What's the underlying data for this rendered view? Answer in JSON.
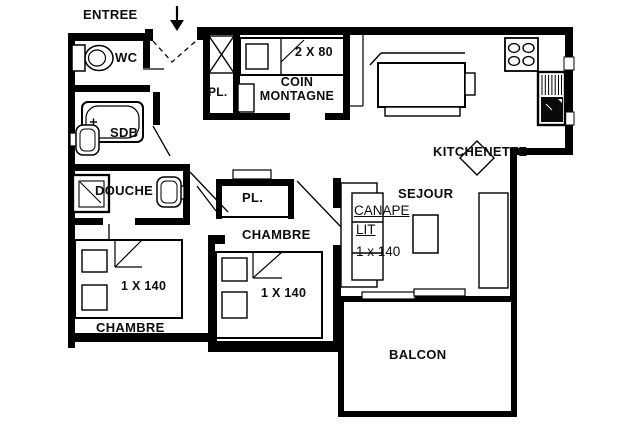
{
  "title": "Apartment floor plan",
  "colors": {
    "wall": "#000000",
    "background": "#ffffff",
    "ink": "#0d0d0d"
  },
  "rooms": {
    "entree": {
      "label": "ENTREE"
    },
    "wc": {
      "label": "WC"
    },
    "sdb": {
      "label": "SDB"
    },
    "douche": {
      "label": "DOUCHE"
    },
    "closet_entree": {
      "label": "PL."
    },
    "coin_montagne": {
      "label_line1": "COIN",
      "label_line2": "MONTAGNE",
      "bed_label": "2 X 80"
    },
    "kitchenette": {
      "label": "KITCHENETTE"
    },
    "sejour": {
      "label": "SEJOUR",
      "sofa_label_line1": "CANAPE",
      "sofa_label_line2": "LIT",
      "sofa_label_line3": "1 x 140"
    },
    "chambre_left": {
      "label": "CHAMBRE",
      "bed_label": "1 X 140"
    },
    "chambre_middle": {
      "label": "CHAMBRE",
      "bed_label": "1 X 140",
      "closet_label": "PL."
    },
    "balcon": {
      "label": "BALCON"
    }
  }
}
